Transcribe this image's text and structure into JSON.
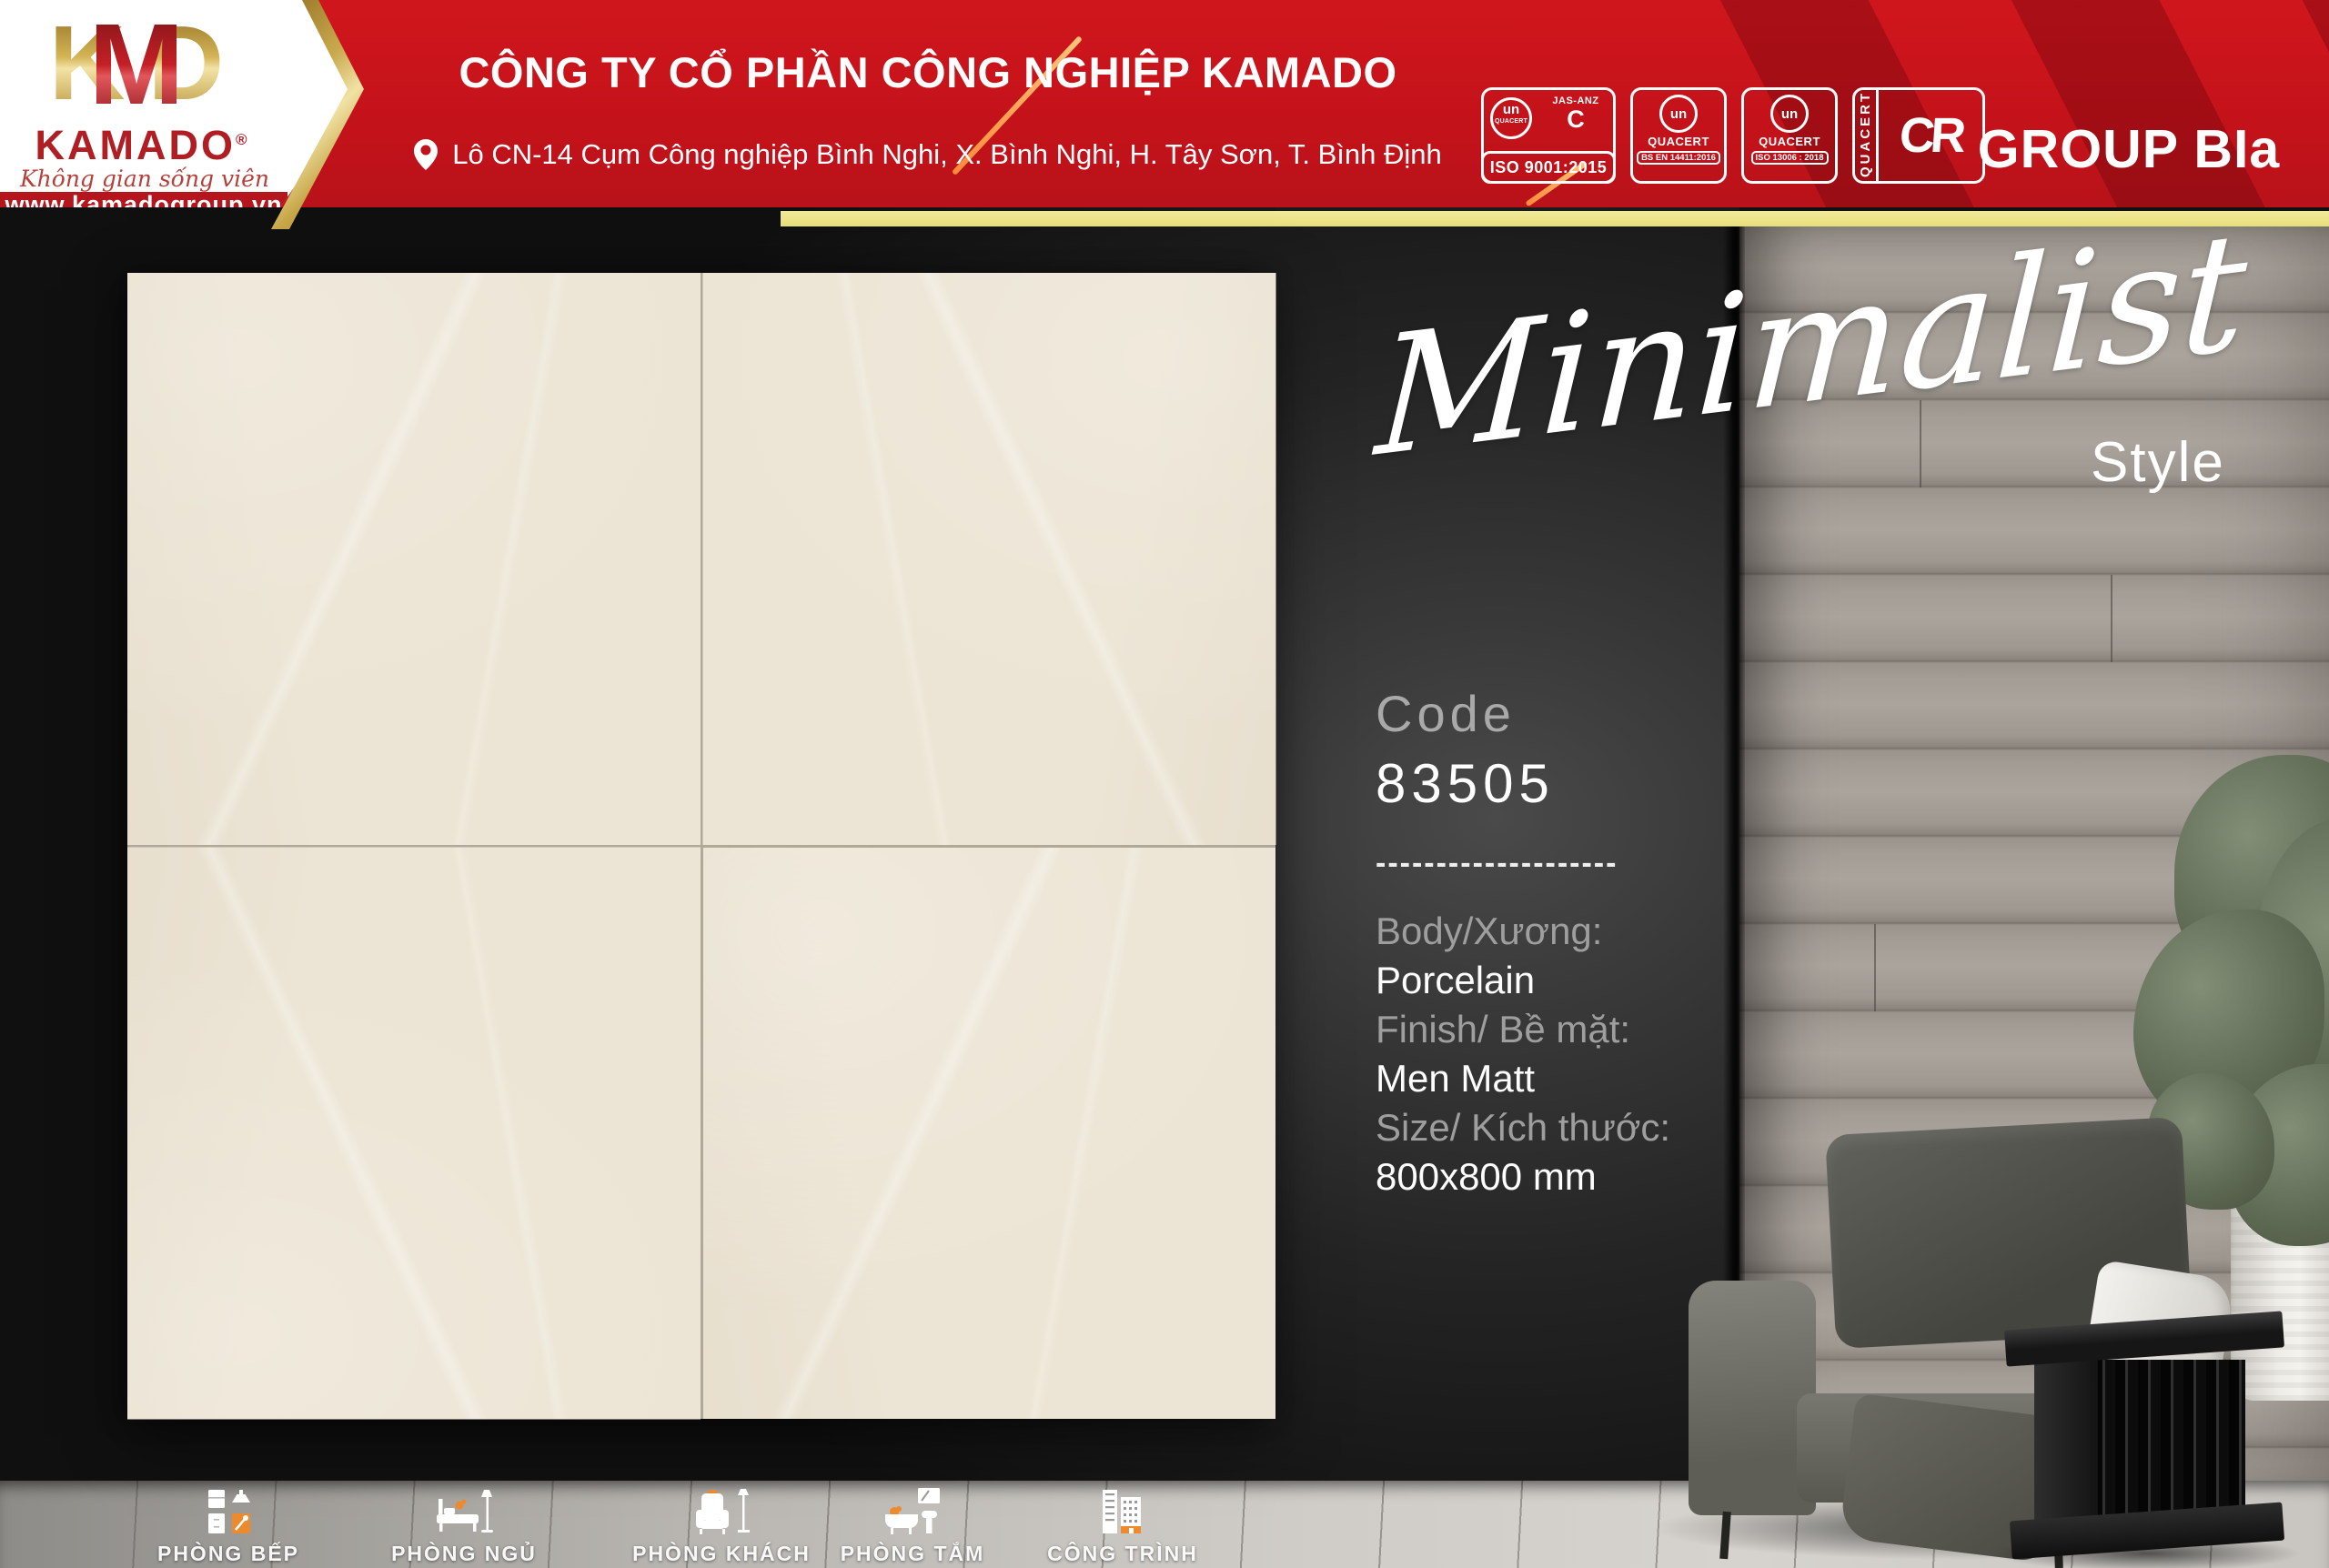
{
  "header": {
    "logo": {
      "letters": {
        "k": "K",
        "m": "M",
        "d": "D"
      },
      "brand": "KAMADO",
      "reg": "®",
      "tagline": "Không gian sống viên mãn",
      "website": "www.kamadogroup.vn"
    },
    "company_name": "CÔNG TY CỔ PHẦN CÔNG NGHIỆP KAMADO",
    "address": "Lô CN-14 Cụm Công nghiệp Bình Nghi, X. Bình Nghi, H. Tây Sơn, T. Bình Định",
    "certifications": [
      {
        "mark": "un",
        "org": "QUACERT",
        "partner": "JAS-ANZ",
        "partner_mark": "C",
        "label": "ISO 9001:2015"
      },
      {
        "mark": "un",
        "org": "QUACERT",
        "label": "BS EN 14411:2016"
      },
      {
        "mark": "un",
        "org": "QUACERT",
        "label": "ISO 13006 : 2018"
      },
      {
        "mark": "CR",
        "org": "QUACERT"
      }
    ],
    "group_label": "GROUP BIa"
  },
  "hero": {
    "script": "Minimalist",
    "suffix": "Style"
  },
  "product": {
    "code_label": "Code",
    "code_value": "83505",
    "divider": "--------------------",
    "specs": [
      {
        "label": "Body/Xương:",
        "value": "Porcelain"
      },
      {
        "label": "Finish/ Bề mặt:",
        "value": "Men Matt"
      },
      {
        "label": "Size/ Kích thước:",
        "value": "800x800 mm"
      }
    ]
  },
  "footer_nav": [
    {
      "label": "PHÒNG BẾP"
    },
    {
      "label": "PHÒNG NGỦ"
    },
    {
      "label": "PHÒNG KHÁCH"
    },
    {
      "label": "PHÒNG TẮM"
    },
    {
      "label": "CÔNG TRÌNH"
    }
  ],
  "colors": {
    "header_red": "#c9141b",
    "gold": "#c9a84c",
    "accent_orange": "#f08a2e",
    "tile_cream": "#ece4d4",
    "yellow_strip": "#efe794",
    "text_gray": "#9e9e9e"
  }
}
